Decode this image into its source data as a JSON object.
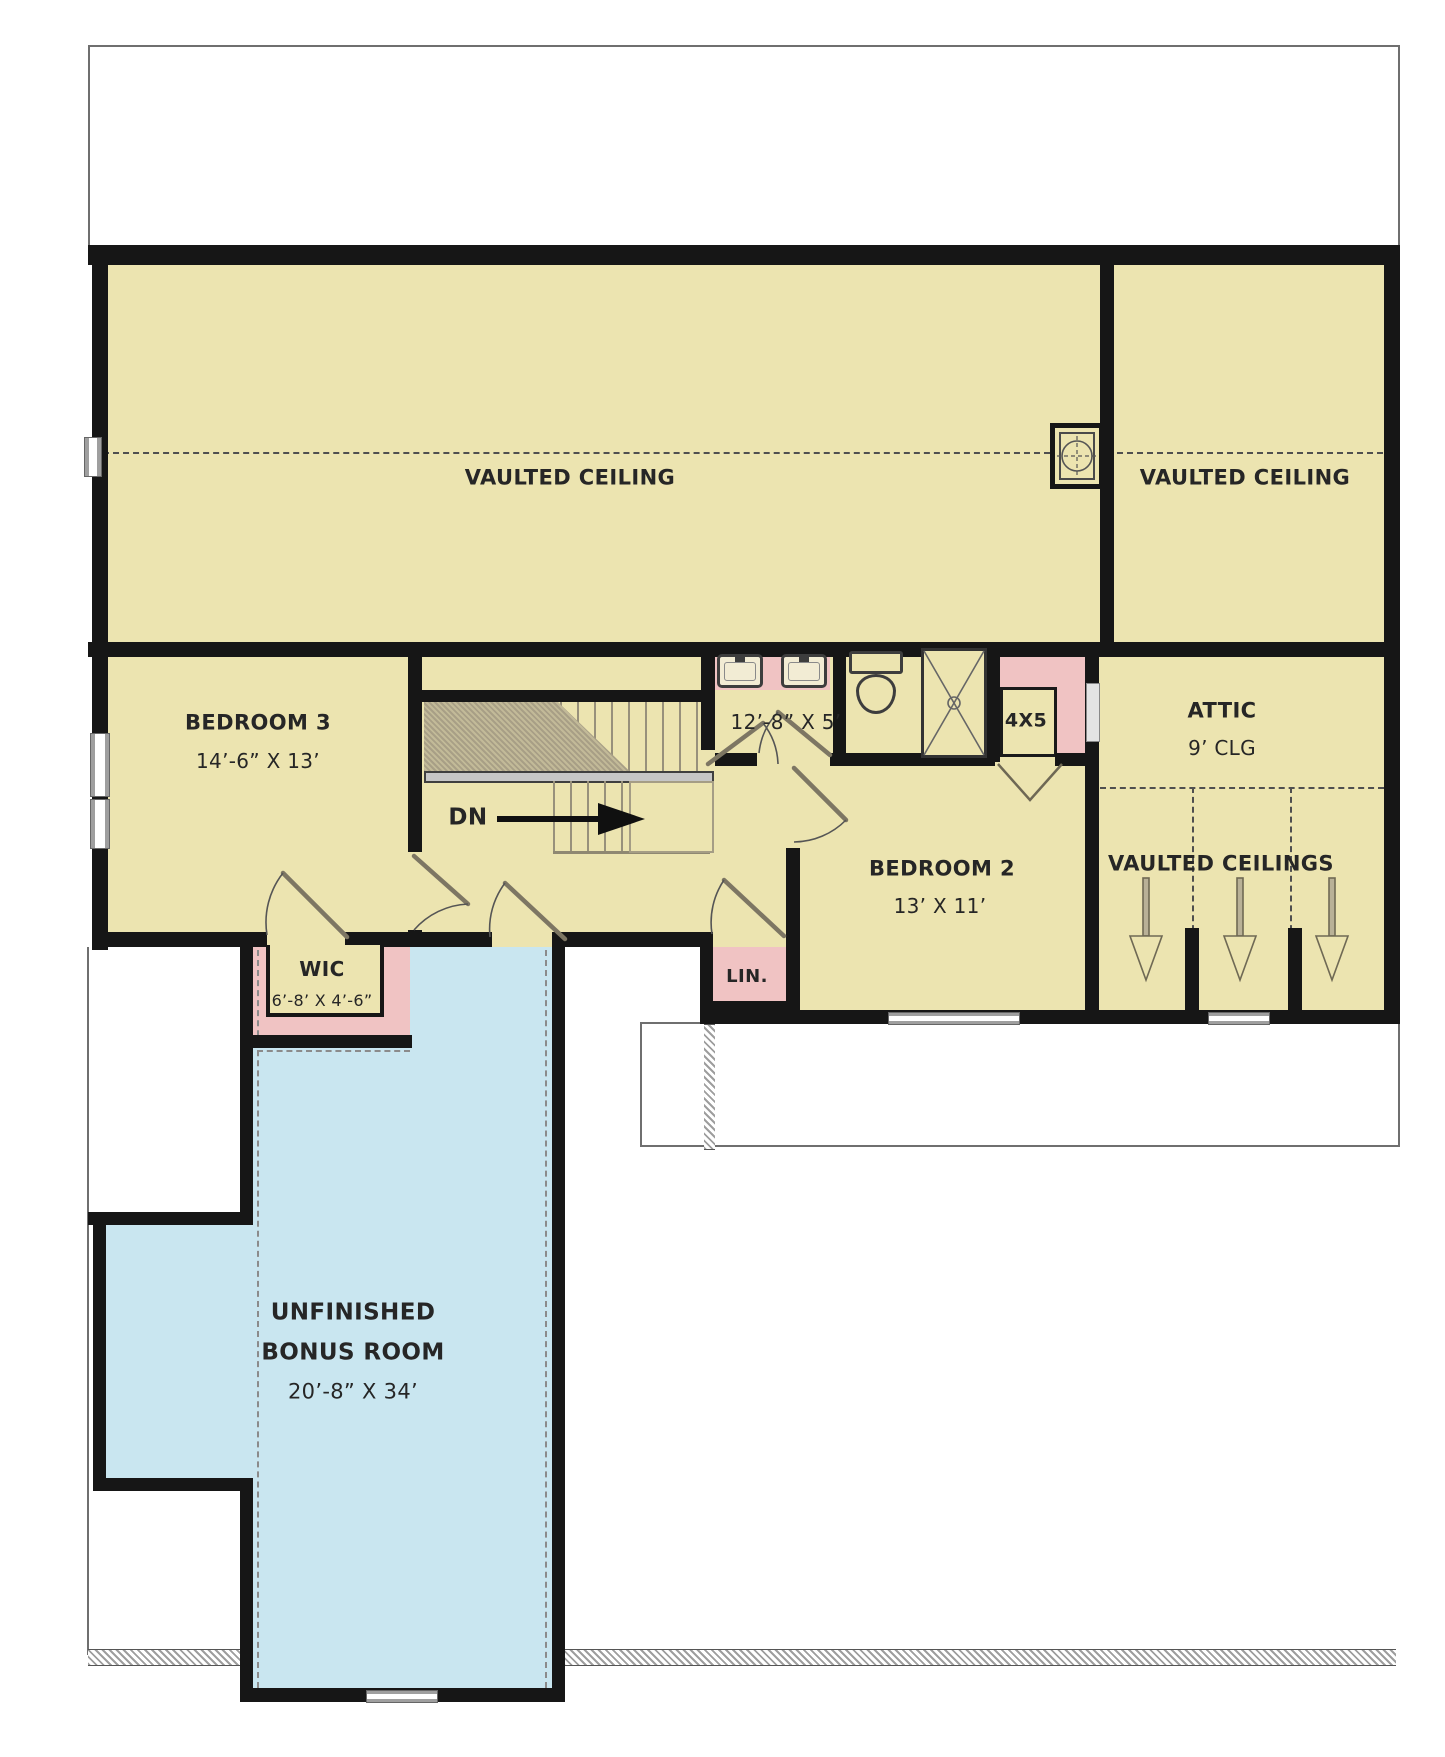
{
  "title": "Second Floor Plan",
  "colors": {
    "room": "#ece4b0",
    "closet": "#f0c3c3",
    "bonus": "#c9e6f0",
    "wall": "#161616",
    "text": "#262626"
  },
  "rooms": {
    "vaulted_left": {
      "label": "VAULTED CEILING"
    },
    "vaulted_right": {
      "label": "VAULTED CEILING"
    },
    "vaulted_bays": {
      "label": "VAULTED CEILINGS"
    },
    "bedroom3": {
      "name": "BEDROOM 3",
      "dimensions": "14’-6” X 13’"
    },
    "bedroom2": {
      "name": "BEDROOM 2",
      "dimensions": "13’ X 11’"
    },
    "bathroom": {
      "dimensions": "12’-8” X 5’"
    },
    "closet_4x5": {
      "label": "4X5"
    },
    "attic": {
      "name": "ATTIC",
      "ceiling": "9’ CLG"
    },
    "wic": {
      "name": "WIC",
      "dimensions": "6’-8’ X 4’-6”"
    },
    "linen": {
      "label": "LIN."
    },
    "bonus": {
      "line1": "UNFINISHED",
      "line2": "BONUS ROOM",
      "dimensions": "20’-8” X 34’"
    },
    "stairs": {
      "down_label": "DN"
    }
  }
}
